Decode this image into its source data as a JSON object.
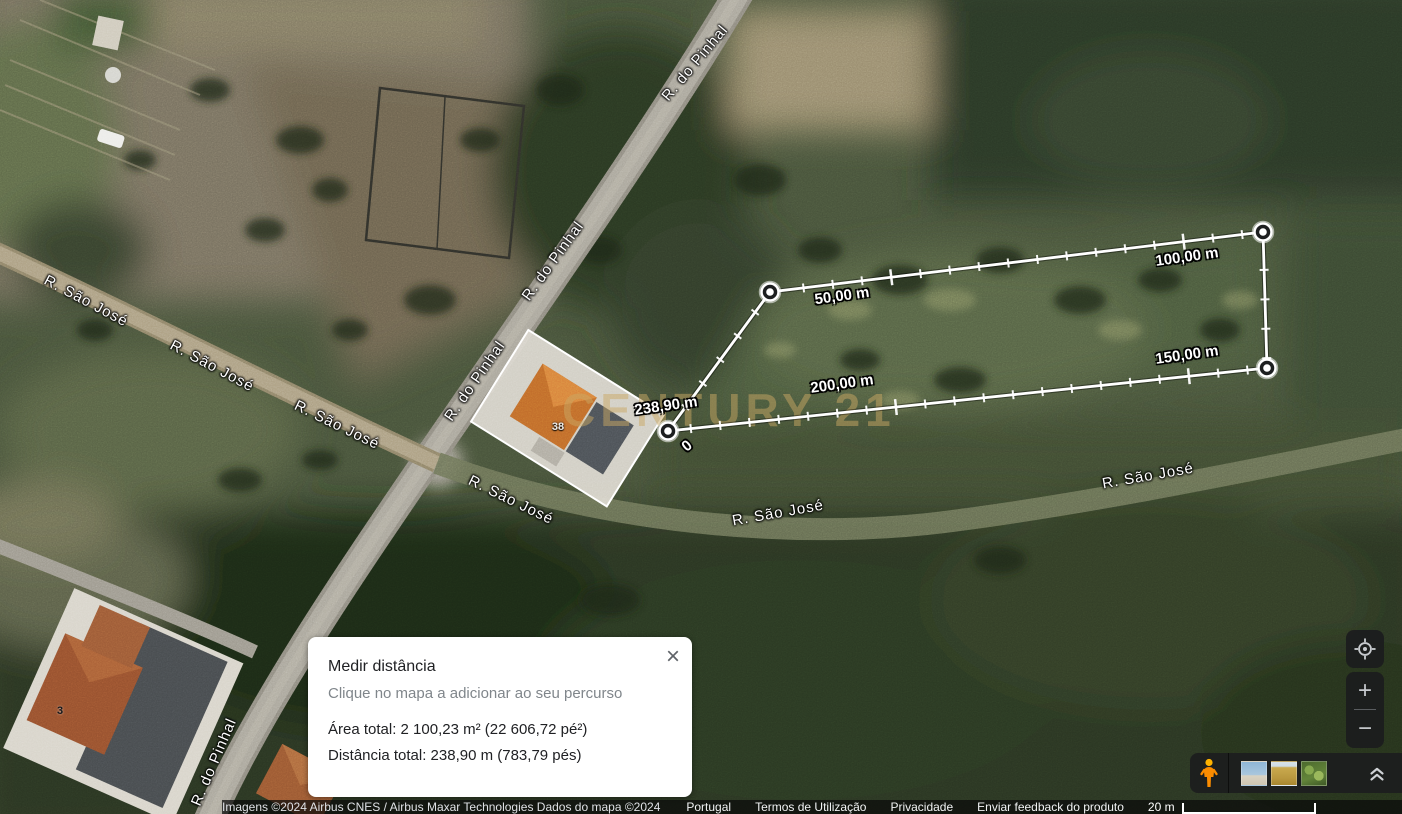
{
  "watermark": {
    "text": "CENTURY 21",
    "color": "rgba(202,167,99,0.5)"
  },
  "map": {
    "road_labels": [
      {
        "text": "R. do Pinhal",
        "x": 695,
        "y": 63,
        "rot": -50
      },
      {
        "text": "R. do Pinhal",
        "x": 553,
        "y": 261,
        "rot": -54
      },
      {
        "text": "R. do Pinhal",
        "x": 475,
        "y": 381,
        "rot": -55
      },
      {
        "text": "R. do Pinhal",
        "x": 214,
        "y": 762,
        "rot": -67
      },
      {
        "text": "R. São José",
        "x": 86,
        "y": 301,
        "rot": 28
      },
      {
        "text": "R. São José",
        "x": 212,
        "y": 366,
        "rot": 28
      },
      {
        "text": "R. São José",
        "x": 337,
        "y": 425,
        "rot": 26
      },
      {
        "text": "R. São José",
        "x": 511,
        "y": 500,
        "rot": 26
      },
      {
        "text": "R. São José",
        "x": 778,
        "y": 513,
        "rot": -10
      },
      {
        "text": "R. São José",
        "x": 1148,
        "y": 476,
        "rot": -10
      }
    ],
    "house_numbers": [
      {
        "text": "38",
        "x": 558,
        "y": 427,
        "tone": "light"
      },
      {
        "text": "3",
        "x": 60,
        "y": 711,
        "tone": "dark"
      }
    ]
  },
  "measurement": {
    "total_m": 238.9,
    "tick_interval_m": 5,
    "major_tick_every_m": 50,
    "line_color": "#ffffff",
    "vertices": [
      [
        668,
        431
      ],
      [
        770,
        292
      ],
      [
        1263,
        232
      ],
      [
        1267,
        368
      ]
    ],
    "labels": [
      {
        "text": "0",
        "x": 687,
        "y": 446,
        "rot": -40
      },
      {
        "text": "50,00 m",
        "x": 842,
        "y": 296,
        "rot": -8
      },
      {
        "text": "100,00 m",
        "x": 1187,
        "y": 257,
        "rot": -8
      },
      {
        "text": "150,00 m",
        "x": 1187,
        "y": 355,
        "rot": -8
      },
      {
        "text": "200,00 m",
        "x": 842,
        "y": 384,
        "rot": -8
      },
      {
        "text": "238,90 m",
        "x": 666,
        "y": 406,
        "rot": -8
      }
    ]
  },
  "panel": {
    "title": "Medir distância",
    "subtitle": "Clique no mapa a adicionar ao seu percurso",
    "area_line": "Área total: 2 100,23 m² (22 606,72 pé²)",
    "distance_line": "Distância total: 238,90 m (783,79 pés)",
    "close_icon": "×"
  },
  "controls": {
    "zoom_in": "+",
    "zoom_out": "−",
    "icon_color": "#c7cace",
    "background": "rgba(28,29,30,0.94)",
    "pegman_color": "#fb8c00"
  },
  "bottom_bar": {
    "thumbnails": [
      {
        "name": "coast-imagery-thumbnail"
      },
      {
        "name": "field-imagery-thumbnail"
      },
      {
        "name": "forest-imagery-thumbnail"
      }
    ]
  },
  "footer": {
    "attribution": "Imagens ©2024 Airbus CNES / Airbus Maxar Technologies Dados do mapa ©2024",
    "links": [
      "Portugal",
      "Termos de Utilização",
      "Privacidade",
      "Enviar feedback do produto"
    ],
    "scale_label": "20 m"
  }
}
